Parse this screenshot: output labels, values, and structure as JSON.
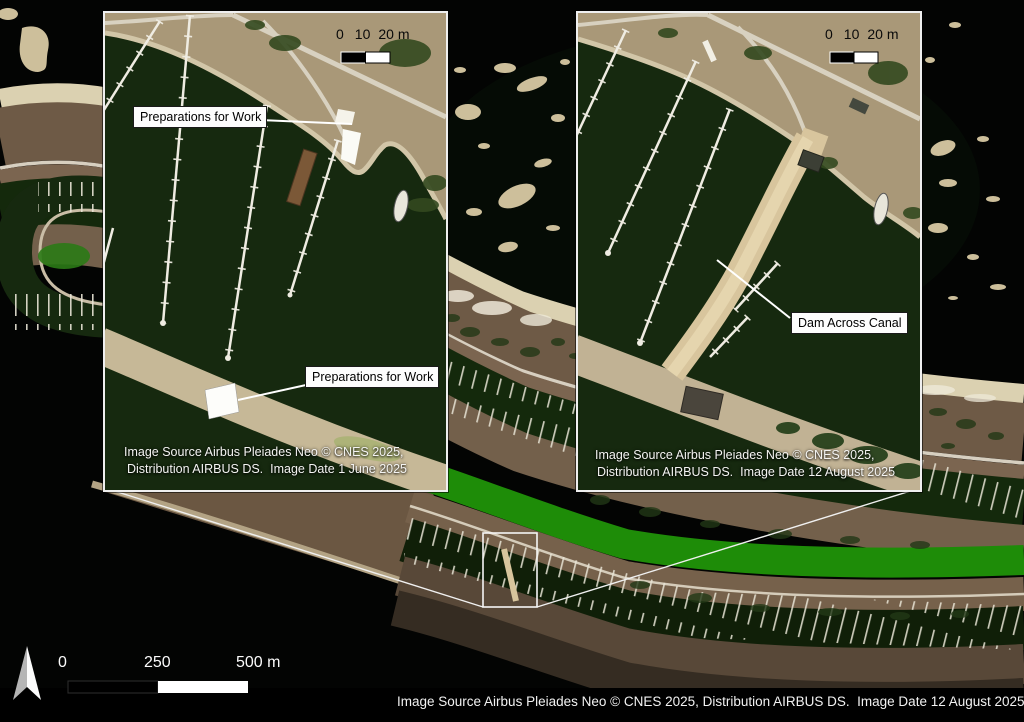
{
  "main": {
    "attribution": "Image Source Airbus Pleiades Neo © CNES 2025, Distribution AIRBUS DS.  Image Date 12 August 2025",
    "scale_bar": {
      "t0": "0",
      "t1": "250",
      "t2": "500 m"
    }
  },
  "inset_june": {
    "label_top": "Preparations for Work",
    "label_bottom": "Preparations for Work",
    "scale_bar": {
      "t0": "0",
      "t1": "10",
      "t2": "20 m"
    },
    "attribution_line1": "Image Source Airbus Pleiades Neo © CNES 2025,",
    "attribution_line2": "Distribution AIRBUS DS.  Image Date 1 June 2025"
  },
  "inset_august": {
    "label_dam": "Dam Across Canal",
    "scale_bar": {
      "t0": "0",
      "t1": "10",
      "t2": "20 m"
    },
    "attribution_line1": "Image Source Airbus Pleiades Neo © CNES 2025,",
    "attribution_line2": "Distribution AIRBUS DS.  Image Date 12 August 2025"
  },
  "colors": {
    "water_dark": "#15280d",
    "canal_green": "#1e8c08",
    "sand": "#dbd1b1",
    "land_brown": "#6e5a46",
    "pier_white": "#efece2",
    "label_bg": "#fdfdfd",
    "label_text": "#000000"
  }
}
